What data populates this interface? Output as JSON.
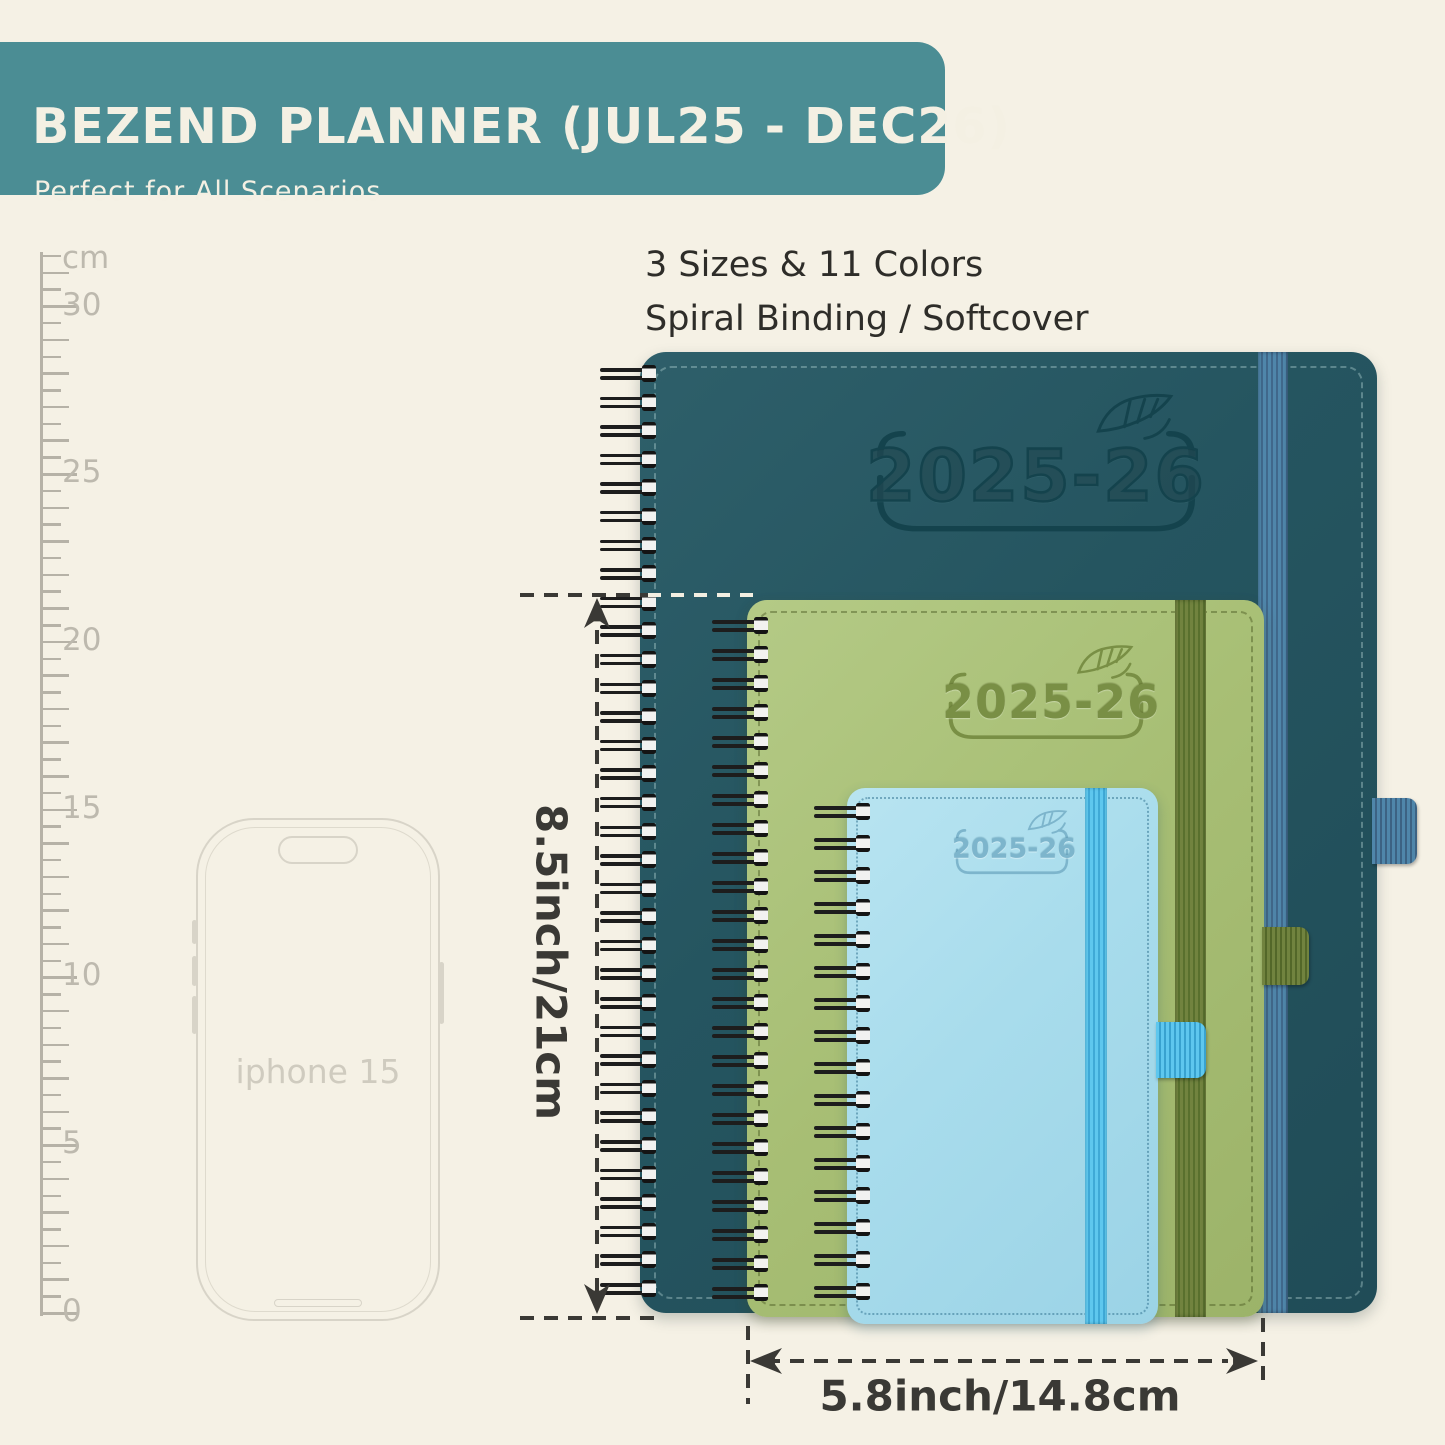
{
  "banner": {
    "title": "BEZEND PLANNER (JUL25 - DEC26)",
    "subtitle": "Perfect for All Scenarios",
    "bg_color": "#4b8d94",
    "text_color": "#f4f0e3"
  },
  "features": {
    "line1": "3 Sizes & 11 Colors",
    "line2": "Spiral Binding / Softcover"
  },
  "ruler": {
    "unit": "cm",
    "major_labels": [
      "30",
      "25",
      "20",
      "15",
      "10",
      "5",
      "0"
    ]
  },
  "phone": {
    "label": "iphone 15"
  },
  "planners": {
    "large": {
      "year": "2025-26",
      "cover_color": "#255560",
      "band_color": "#4f86aa"
    },
    "medium": {
      "year": "2025-26",
      "cover_color": "#a8bf75",
      "band_color": "#6b7d3f"
    },
    "small": {
      "year": "2025-26",
      "cover_color": "#a8dcec",
      "band_color": "#55c1e9"
    }
  },
  "dimensions": {
    "height_label": "8.5inch/21cm",
    "width_label": "5.8inch/14.8cm"
  }
}
